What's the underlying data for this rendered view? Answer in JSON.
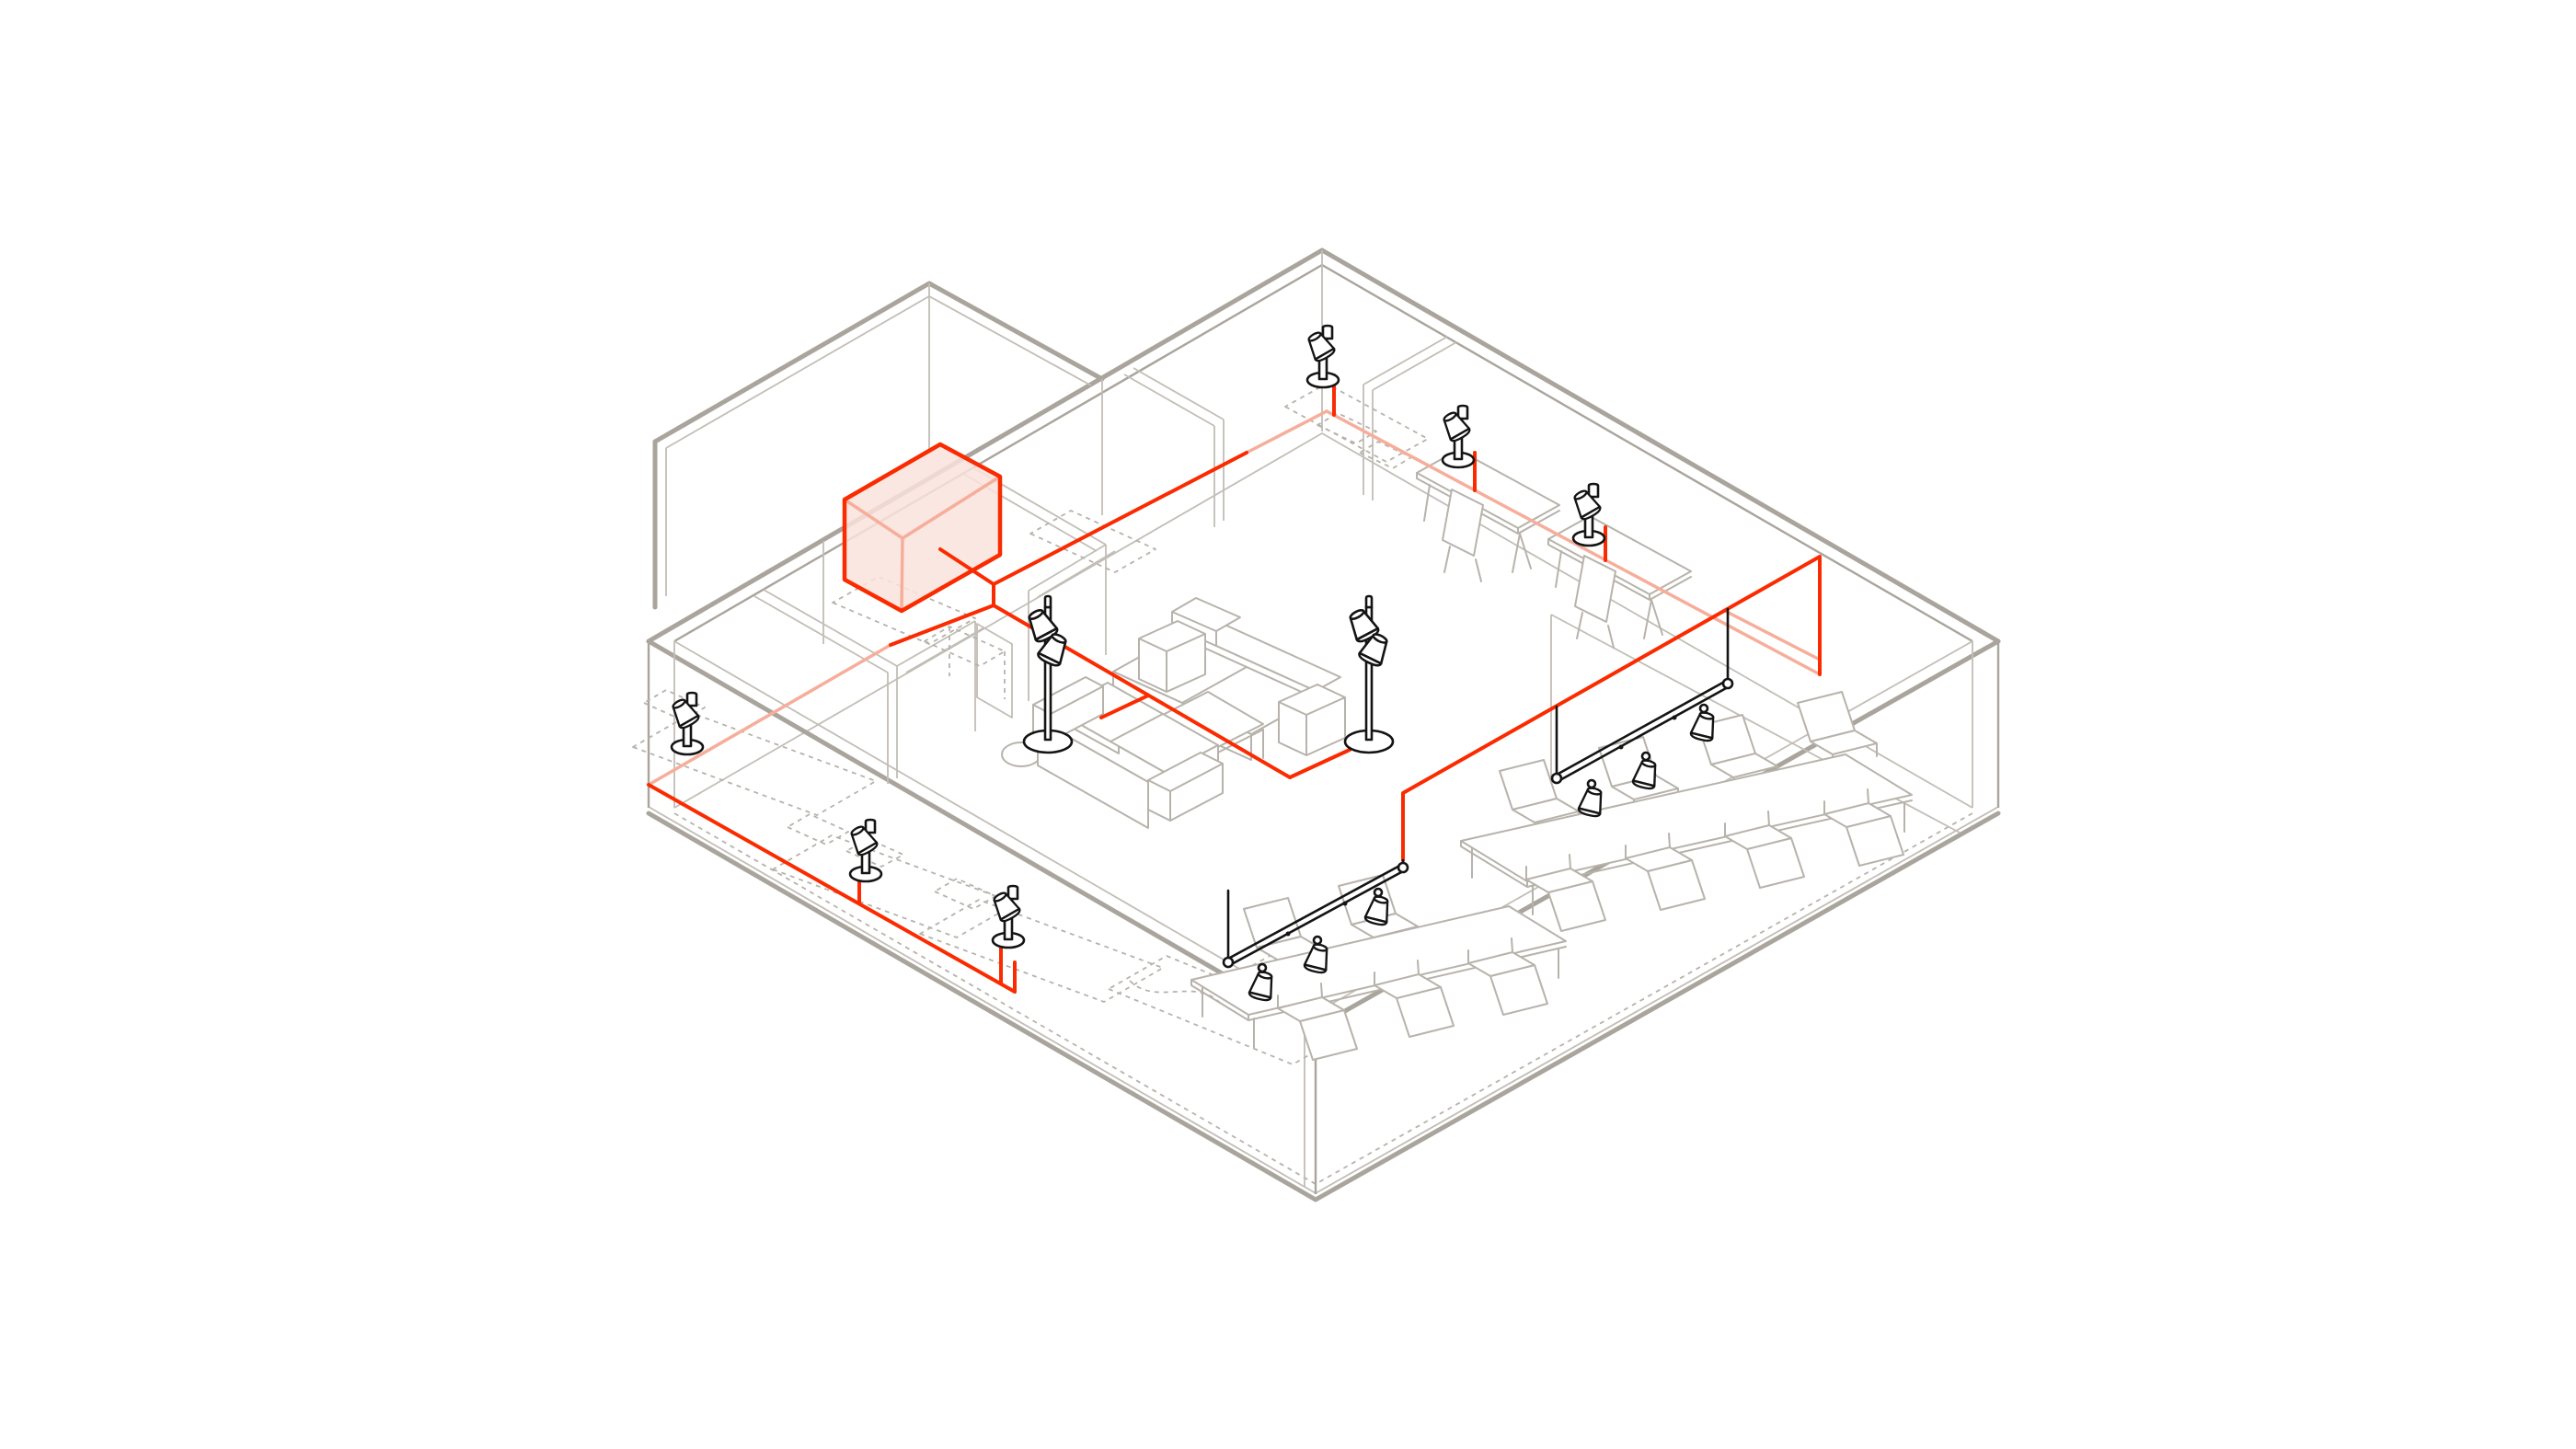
{
  "scene": {
    "description": "Isometric cutaway diagram of an office interior: red electrical wiring routed from a highlighted junction box along wall bases and ceiling to desk lamps, floor lamps and suspended track lights",
    "background": "#ffffff"
  },
  "colors": {
    "background": "#ffffff",
    "wire": "#fa2b00",
    "wire_hidden": "#f6ae9b",
    "junction_box_fill": "#fae3dc",
    "junction_box_outline": "#fa2b00",
    "wall_outer": "#a9a49c",
    "wall_inner": "#c2beb6",
    "furniture": "#b7b3ab",
    "fixture_black": "#141414"
  },
  "elements": {
    "junction_box": {
      "name": "electrical-junction-box",
      "highlighted": true
    },
    "rooms": [
      "entry-vestibule",
      "main-open-space",
      "left-room-a",
      "left-room-b",
      "top-corner-room",
      "right-conference-area"
    ],
    "fixtures": {
      "desk_lamps": 6,
      "floor_lamps": 2,
      "track_lights": 2,
      "spots_per_track": 3
    },
    "furniture": {
      "sofas": 2,
      "coffee_tables": 1,
      "side_tables": 1,
      "large_tables": 2,
      "table_chairs": 13,
      "desk_chairs": 2,
      "solid_desks": 2,
      "dashed_desks": 6,
      "dashed_bed": 1
    }
  },
  "wiring_runs": [
    "junction-box-stub",
    "northwest-wall-base-run",
    "northeast-wall-base-run-with-three-risers",
    "southwest-wall-base-run-with-risers",
    "lounge-floor-run-to-floor-lamps",
    "ceiling-run-to-track-lights"
  ]
}
